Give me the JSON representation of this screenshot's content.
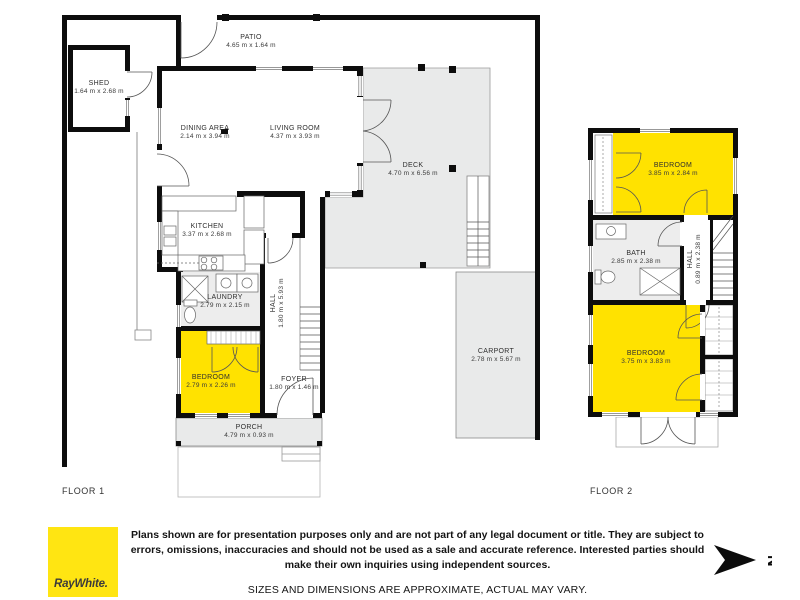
{
  "floor1": {
    "label": "FLOOR 1",
    "rooms": [
      {
        "name": "SHED",
        "dims": "1.64 m x 2.68 m"
      },
      {
        "name": "PATIO",
        "dims": "4.65 m x 1.64 m"
      },
      {
        "name": "DINING AREA",
        "dims": "2.14 m x 3.94 m"
      },
      {
        "name": "LIVING ROOM",
        "dims": "4.37 m x 3.93 m"
      },
      {
        "name": "KITCHEN",
        "dims": "3.37 m x 2.68 m"
      },
      {
        "name": "DECK",
        "dims": "4.70 m x 6.56 m"
      },
      {
        "name": "LAUNDRY",
        "dims": "2.79 m x 2.15 m"
      },
      {
        "name": "HALL",
        "dims": "1.80 m x 5.93 m"
      },
      {
        "name": "BEDROOM",
        "dims": "2.79 m x 2.26 m"
      },
      {
        "name": "FOYER",
        "dims": "1.80 m x 1.46 m"
      },
      {
        "name": "PORCH",
        "dims": "4.79 m x 0.93 m"
      },
      {
        "name": "CARPORT",
        "dims": "2.78 m x 5.67 m"
      }
    ]
  },
  "floor2": {
    "label": "FLOOR 2",
    "rooms": [
      {
        "name": "BEDROOM",
        "dims": "3.85 m x 2.84 m"
      },
      {
        "name": "BATH",
        "dims": "2.85 m x 2.38 m"
      },
      {
        "name": "HALL",
        "dims": "0.89 m x 2.38 m"
      },
      {
        "name": "BEDROOM",
        "dims": "3.75 m x 3.83 m"
      }
    ]
  },
  "footer": {
    "brand": "RayWhite.",
    "disclaimer": "Plans shown are for presentation purposes only and are not part of any legal document or title. They are subject to errors, omissions, inaccuracies and should not be used as a sale and accurate reference. Interested parties should make their own inquiries using independent sources.",
    "note": "SIZES AND DIMENSIONS ARE APPROXIMATE, ACTUAL MAY VARY.",
    "compass_letter": "N"
  },
  "colors": {
    "bedroom_highlight": "#FFE200",
    "brand_yellow": "#FFE512",
    "area_gray": "#E9EAEA",
    "wall_black": "#0D0D0D"
  }
}
